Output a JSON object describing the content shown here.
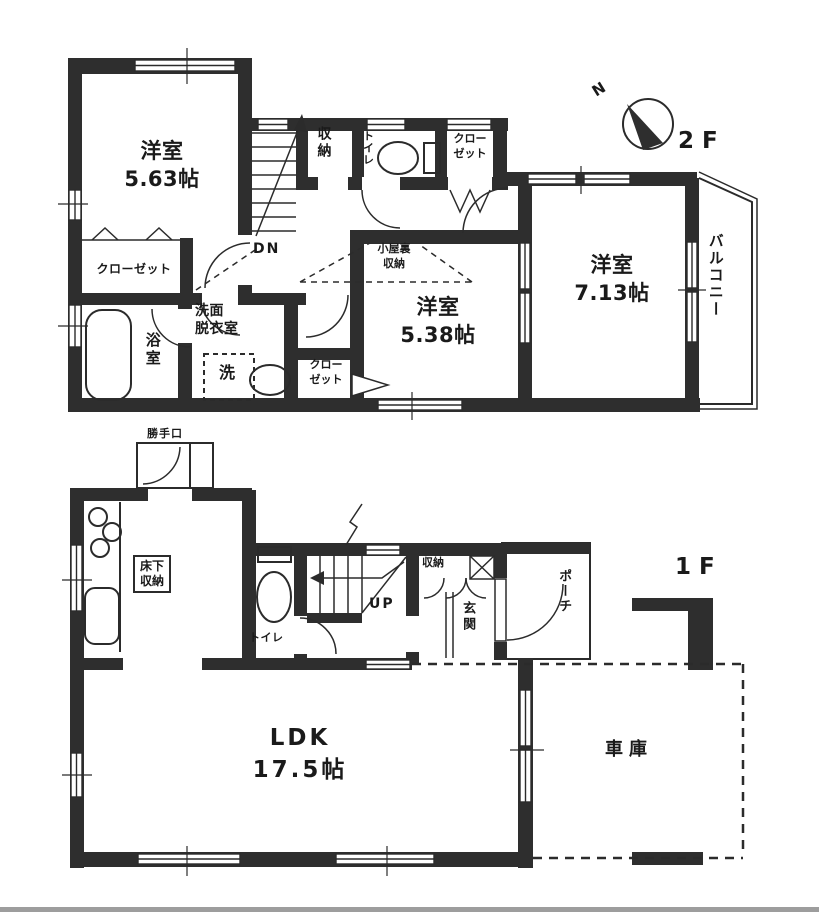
{
  "colors": {
    "wall": "#2e2e2e",
    "line": "#2b2b2b",
    "text": "#1a1a1a",
    "background": "#ffffff"
  },
  "floor2": {
    "label": "2F",
    "compass": "N",
    "bedroom1": "洋室\n5.63帖",
    "closet_left": "クローゼット",
    "bath": "浴室",
    "washroom": "洗面\n脱衣室",
    "laundry": "洗",
    "stairs": "DN",
    "storage": "収納",
    "toilet": "トイレ",
    "closet_top": "クロー\nゼット",
    "attic_storage": "小屋裏\n収納",
    "bedroom2": "洋室\n5.38帖",
    "closet_mid": "クロー\nゼット",
    "bedroom3": "洋室\n7.13帖",
    "balcony": "バルコニー"
  },
  "floor1": {
    "label": "1F",
    "back_door": "勝手口",
    "underfloor_storage": "床下\n収納",
    "toilet": "トイレ",
    "stairs": "UP",
    "storage": "収納",
    "entrance": "玄関",
    "porch": "ポーチ",
    "ldk": "LDK\n17.5帖",
    "garage": "車庫"
  }
}
